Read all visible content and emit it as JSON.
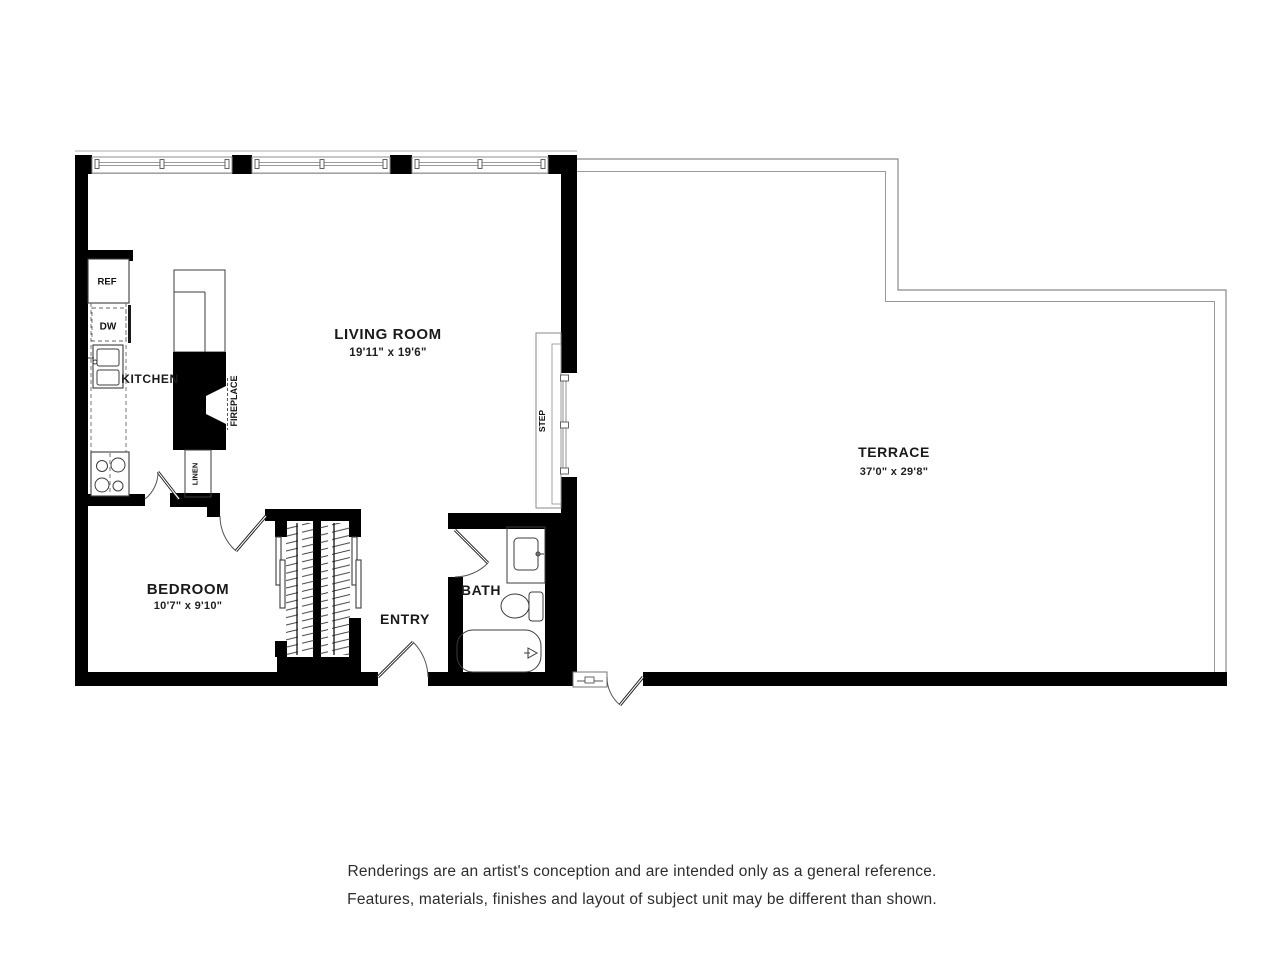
{
  "rooms": {
    "living": {
      "name": "LIVING ROOM",
      "dims": "19'11\" x 19'6\""
    },
    "terrace": {
      "name": "TERRACE",
      "dims": "37'0\" x 29'8\""
    },
    "bedroom": {
      "name": "BEDROOM",
      "dims": "10'7\" x 9'10\""
    },
    "kitchen": {
      "name": "KITCHEN"
    },
    "bath": {
      "name": "BATH"
    },
    "entry": {
      "name": "ENTRY"
    }
  },
  "fixtures": {
    "refrigerator": "REF",
    "dishwasher": "DW",
    "fireplace": "FIREPLACE",
    "linen": "LINEN",
    "step": "STEP"
  },
  "disclaimer": {
    "line1": "Renderings are an artist's conception and are intended only as a general reference.",
    "line2": "Features, materials, finishes and layout of subject unit may be different than shown."
  },
  "colors": {
    "wall": "#000000",
    "thin_line": "#8a8a8a",
    "text": "#1a1a1a",
    "background": "#ffffff"
  }
}
